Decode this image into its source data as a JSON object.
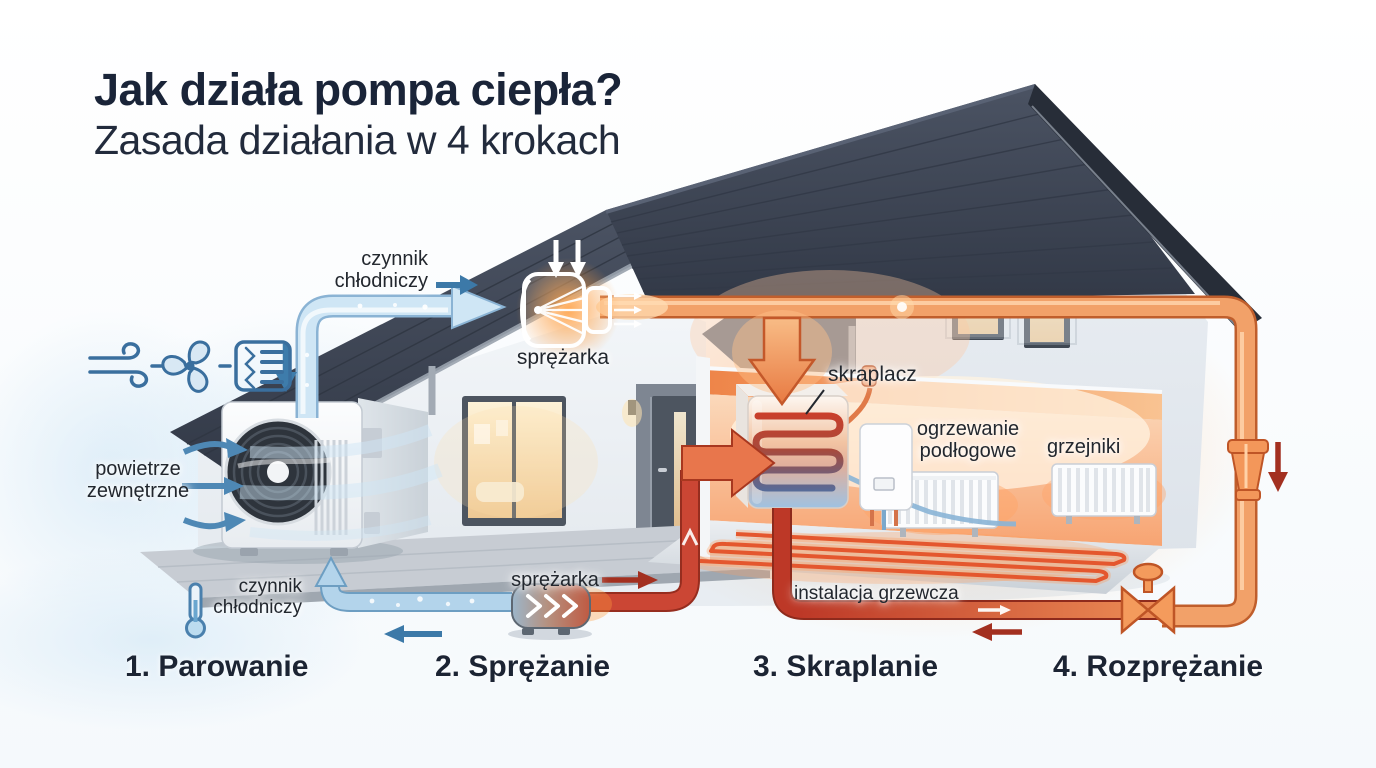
{
  "title": {
    "line1": "Jak działa pompa ciepła?",
    "line2": "Zasada działania w 4 krokach"
  },
  "labels": {
    "refrigerant_top": "czynnik chłodniczy",
    "compressor_top": "sprężarka",
    "outside_air": "powietrze zewnętrzne",
    "refrigerant_bottom": "czynnik chłodniczy",
    "compressor_bottom": "sprężarka",
    "condenser": "skraplacz",
    "floor_heating": "ogrzewanie podłogowe",
    "radiators": "grzejniki",
    "heating_installation": "instalacja grzewcza"
  },
  "steps": [
    {
      "label": "1. Parowanie"
    },
    {
      "label": "2. Sprężanie"
    },
    {
      "label": "3. Skraplanie"
    },
    {
      "label": "4. Rozprężanie"
    }
  ],
  "icons": {
    "wind": "wind-icon",
    "fan": "fan-icon",
    "heat_exchanger": "heat-exchanger-coil-icon",
    "thermometer": "thermometer-icon",
    "compressor_top": "compressor-icon",
    "compressor_bottom": "compressor-tank-icon",
    "condenser_coil": "condenser-coil-icon",
    "expansion_valve": "expansion-valve-icon",
    "expansion_fitting": "expansion-fitting-icon",
    "outdoor_unit": "outdoor-unit-fan-icon",
    "radiator": "radiator-icon",
    "boiler": "boiler-icon"
  },
  "colors": {
    "title": "#1a2438",
    "accent_blue": "#3b6f9d",
    "cold_pipe": "#cfe6f5",
    "cold_pipe_dark": "#8ab3d4",
    "hot_pipe": "#f2a169",
    "hot_pipe_outline": "#c05e2c",
    "hot_red": "#cb4634",
    "dark_red_arrow": "#a33020",
    "roof": "#3c4452",
    "wall": "#e9edf2",
    "warm_room": "#f8ae7c"
  }
}
